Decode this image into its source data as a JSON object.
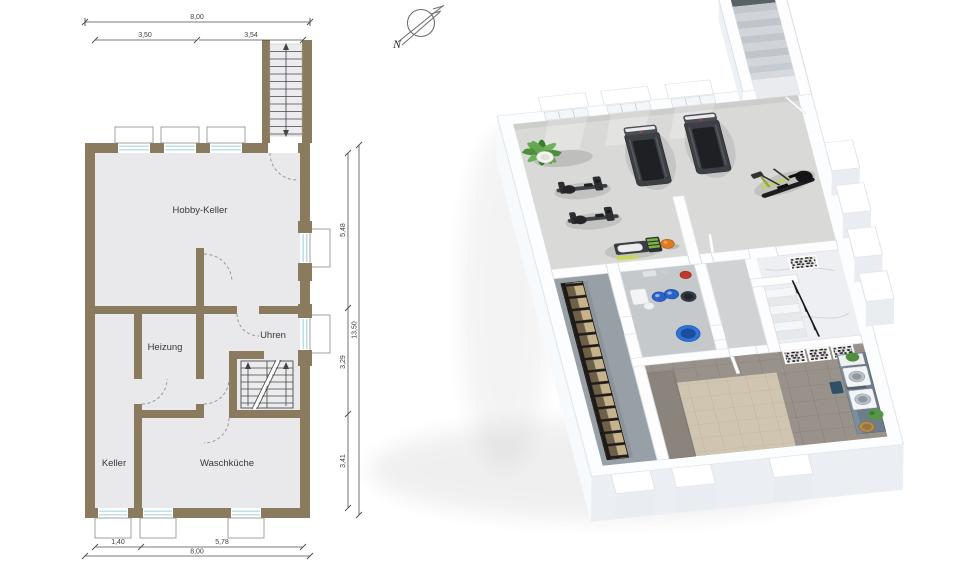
{
  "compass": {
    "north_label": "N"
  },
  "floorplan_2d": {
    "room_labels": {
      "hobby_keller": "Hobby-Keller",
      "heizung": "Heizung",
      "uhren": "Uhren",
      "keller": "Keller",
      "waschkueche": "Waschküche"
    },
    "dimensions": {
      "top_total": "8,00",
      "top_left": "3,50",
      "top_right": "3,54",
      "right_overall": "13,50",
      "right_upper": "5,48",
      "right_middle": "3,29",
      "right_lower": "3,41",
      "bottom_left": "1,40",
      "bottom_middle": "5,78",
      "bottom_total": "8,00"
    }
  },
  "render_3d": {
    "objects": [
      "potted-plant",
      "treadmill",
      "treadmill",
      "exercise-bike",
      "exercise-bike",
      "weight-bench",
      "medicine-ball",
      "elliptical-trainer",
      "storage-rack",
      "boiler-tanks",
      "interior-staircase",
      "exterior-staircase",
      "laundry-counter",
      "washing-machines",
      "wall-artwork"
    ]
  },
  "palette": {
    "wall2d": "#8a7a5e",
    "floor2d": "#e9e9ec",
    "glass": "#a9d5e4",
    "dim": "#4d4d4d",
    "gym_floor": "#d9dad7",
    "concrete": "#98a0a7",
    "tile_brown": "#99928a",
    "tile_beige": "#cfc5b1",
    "counter_slate": "#6e7d8c",
    "equip_dark": "#3c4045",
    "accent_green": "#7cb440",
    "ball_orange": "#dd7a1f",
    "tank_blue": "#2a63c8",
    "tank_red": "#c0392b",
    "rack_tan": "#c6b38c"
  }
}
